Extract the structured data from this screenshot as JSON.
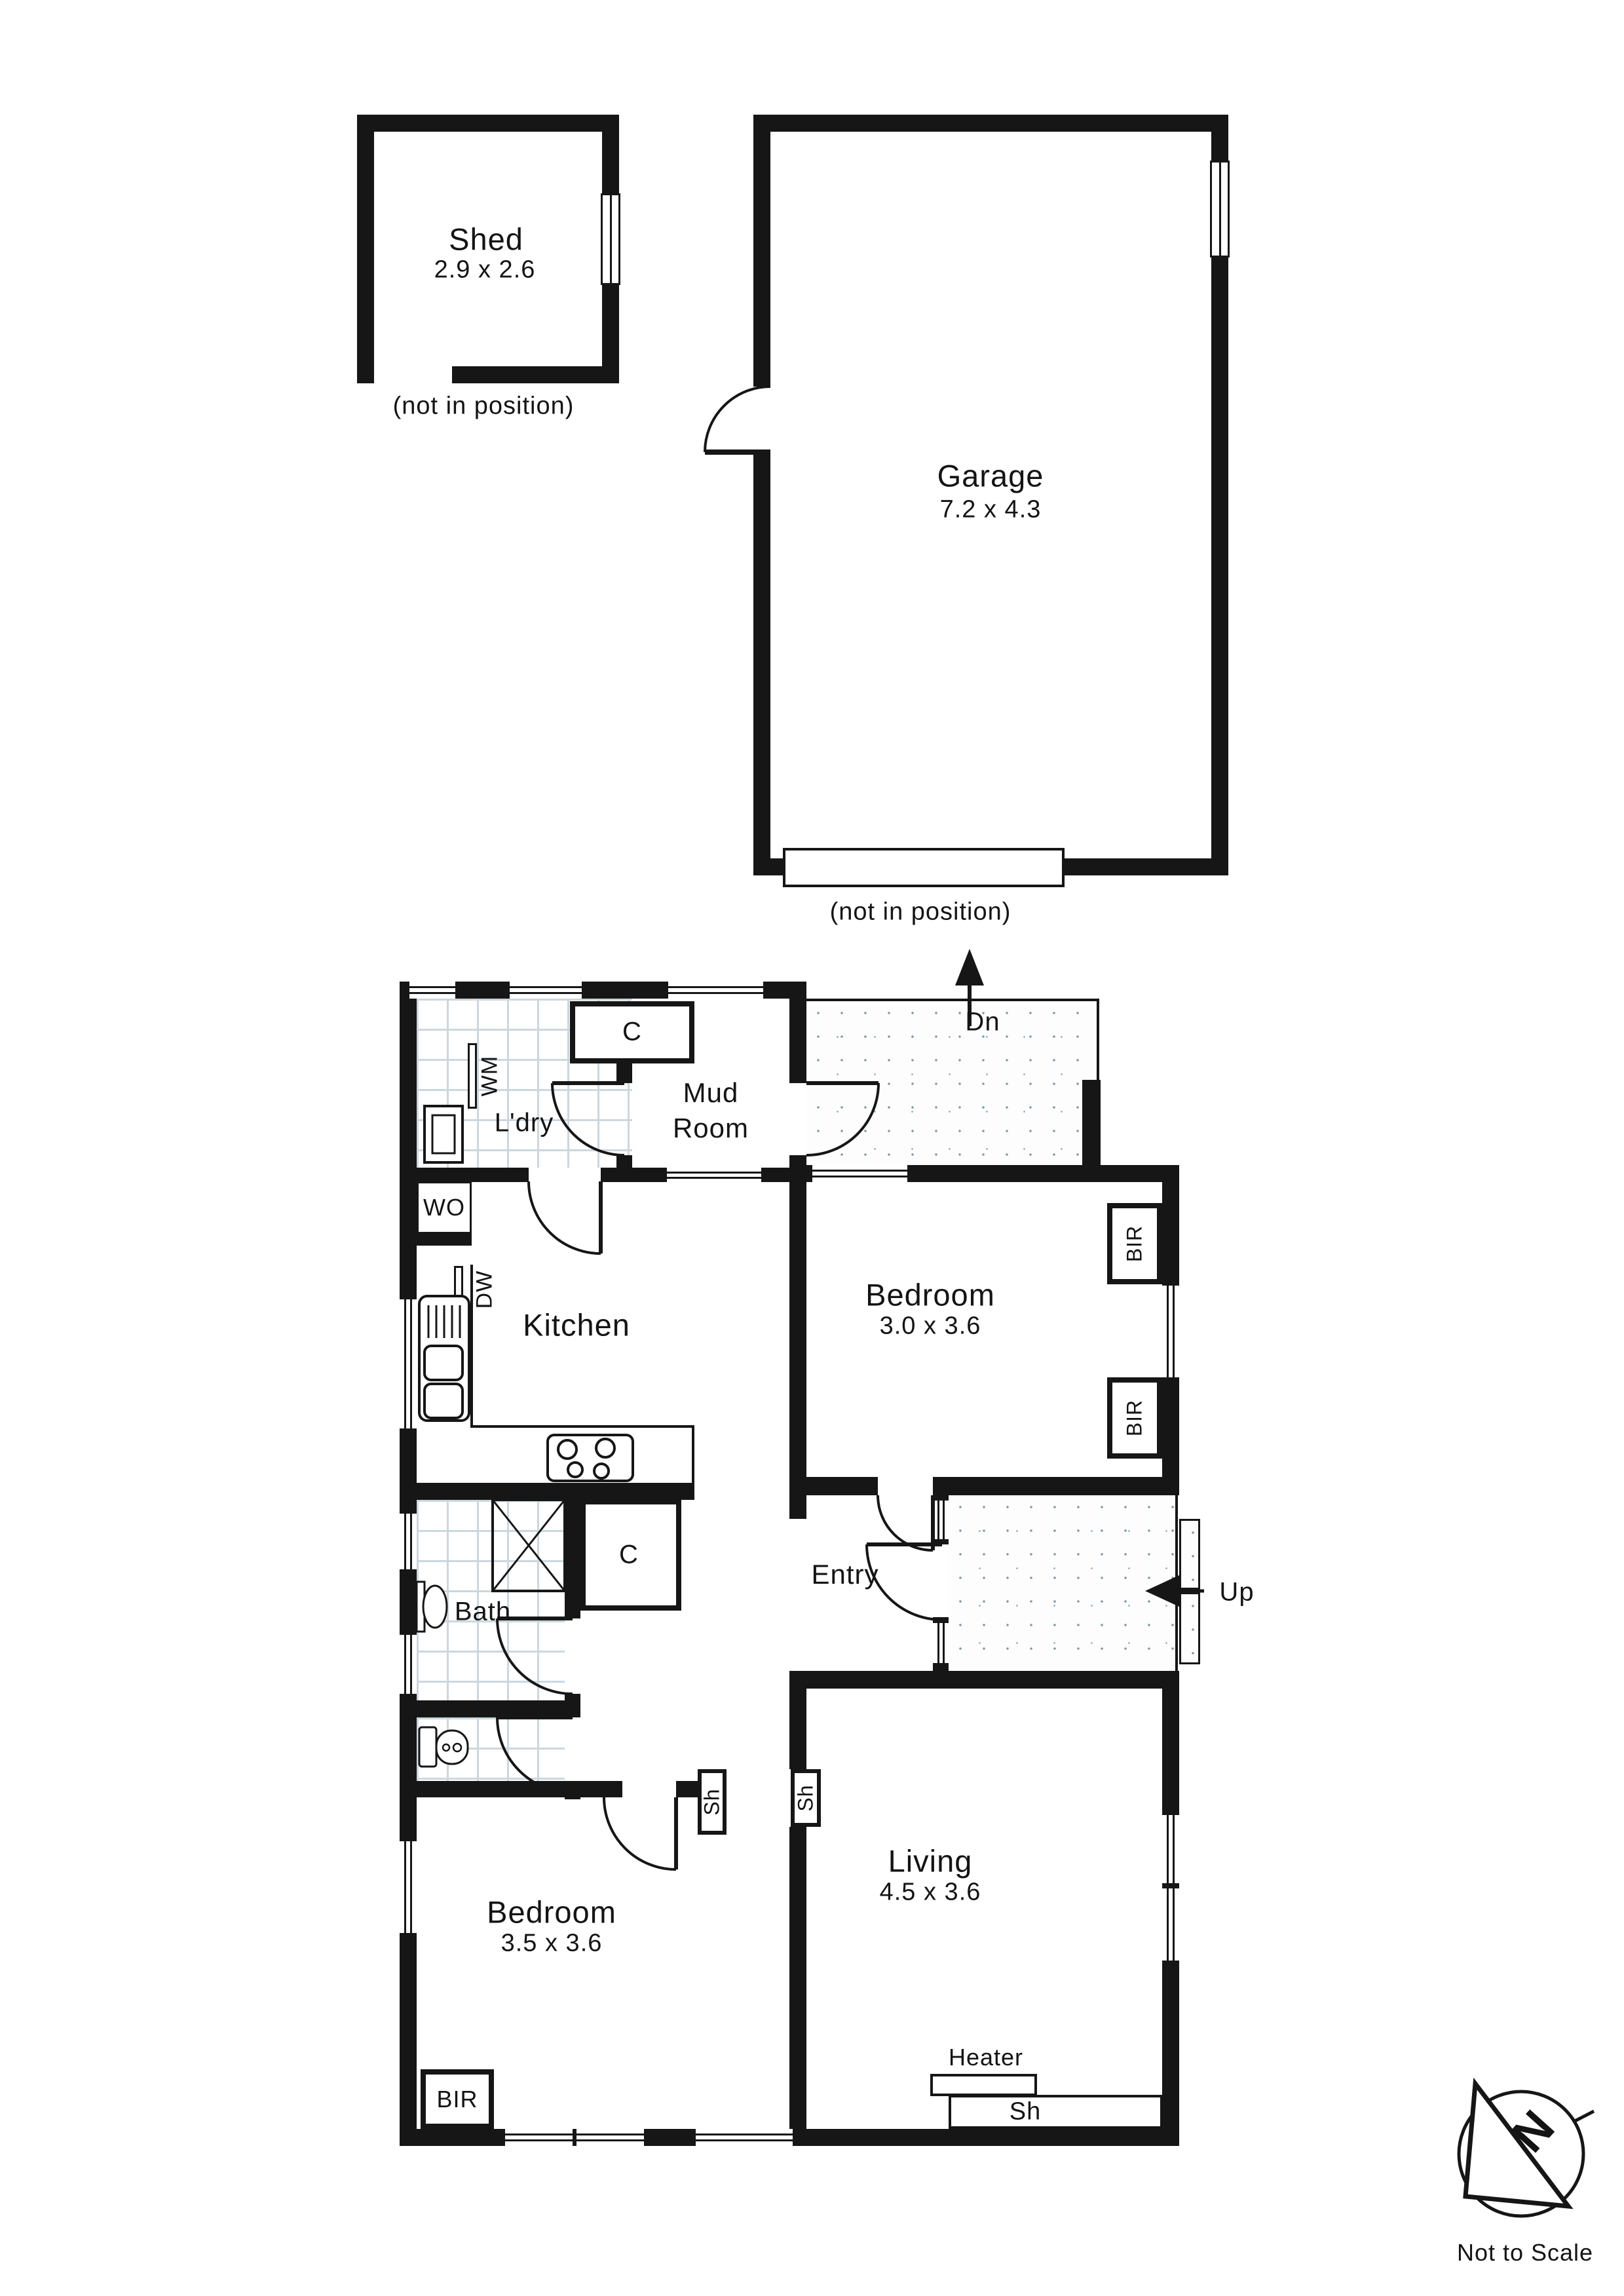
{
  "outbuildings": {
    "shed": {
      "name": "Shed",
      "dims": "2.9 x 2.6",
      "note": "(not in position)"
    },
    "garage": {
      "name": "Garage",
      "dims": "7.2 x 4.3",
      "note": "(not in position)"
    }
  },
  "rooms": {
    "laundry": {
      "name": "L'dry"
    },
    "mudroom": {
      "name_line1": "Mud",
      "name_line2": "Room"
    },
    "kitchen": {
      "name": "Kitchen"
    },
    "bedroom_top": {
      "name": "Bedroom",
      "dims": "3.0 x 3.6"
    },
    "entry": {
      "name": "Entry"
    },
    "bath": {
      "name": "Bath"
    },
    "living": {
      "name": "Living",
      "dims": "4.5 x 3.6"
    },
    "bedroom_bottom": {
      "name": "Bedroom",
      "dims": "3.5 x 3.6"
    }
  },
  "fixtures": {
    "wm": "WM",
    "dw": "DW",
    "wo": "WO",
    "closet": "C",
    "bir": "BIR",
    "shelf": "Sh",
    "heater": "Heater"
  },
  "stairs": {
    "down": "Dn",
    "up": "Up"
  },
  "compass": {
    "north": "N",
    "note": "Not to Scale"
  }
}
